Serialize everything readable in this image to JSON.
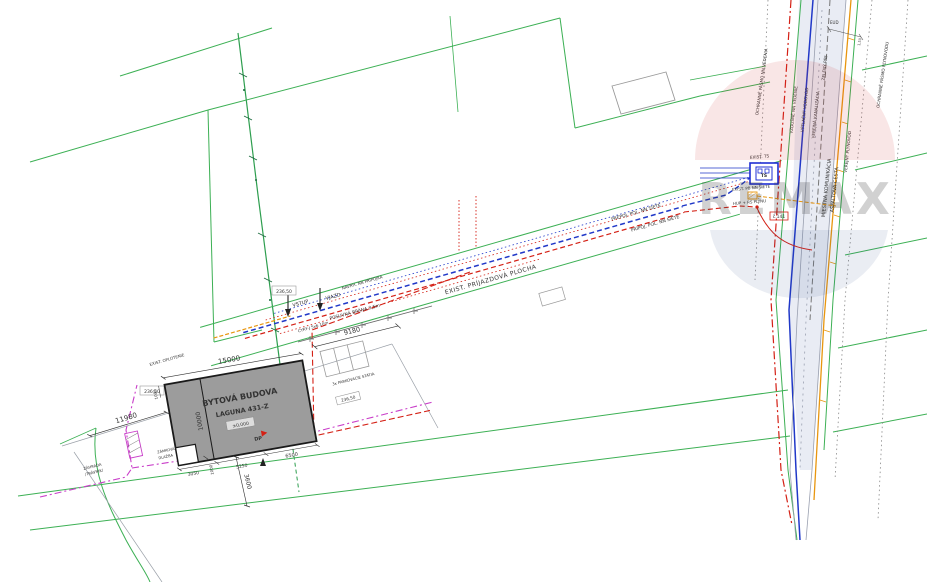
{
  "meta": {
    "title": "Situačný výkres - BYTOVÁ BUDOVA LAGUNA 431-Z"
  },
  "colors": {
    "parcel_green": "#3cb054",
    "boundary_red": "#d42015",
    "cable_blue": "#2038c8",
    "fence_magenta": "#c93ec9",
    "gas_orange": "#e8960f",
    "building_gray": "#9c9c9c",
    "road_tint": "#e2e6f0",
    "watermark_red": "#c03030",
    "watermark_blue": "#33508c"
  },
  "building": {
    "line1": "BYTOVÁ BUDOVA",
    "line2": "LAGUNA 431-Z",
    "elevation": "±0,000",
    "dp": "DP"
  },
  "dimensions": {
    "top": "15000",
    "left": "10000",
    "left_small": "1000",
    "plot": "11980",
    "parking": "9180",
    "bottom_a": "3050",
    "bottom_b": "1000",
    "bottom_c": "5250",
    "bottom_d": "6500",
    "below": "3600",
    "road_top": "EUD",
    "road_ticks": "1,50"
  },
  "site": {
    "vstup": "VSTUP",
    "vjazd": "VJAZD",
    "gate": "POSUVNÁ BRÁNA 3,5m",
    "fence": "EXIST. OPLOTENIE",
    "garden1": "ZÁHRADA",
    "garden2": "/TRÁVNIK/",
    "paving1": "ZÁMKOVÁ",
    "paving2": "DLAŽBA",
    "parking": "3x PARKOVACIE STÁTIA",
    "elev1": "236,50",
    "elev2": "236,50",
    "elev3": "236,50"
  },
  "corridor": {
    "blue": "PREPOJ. POL. NN SIETE",
    "red": "PRÍPOJ. POL. NN SIETE",
    "surface": "EXIST. PRÍJAZDOVÁ PLOCHA",
    "cable_red": "CYKY-J 5x6 10m",
    "cable_blue": "NAVRH. NN PRÍPOJKA"
  },
  "road": {
    "nn": "VZDUŠNÉ NN VEDENIE",
    "water": "VÝTLAČNÝ VODOVOD",
    "sewer": "VEREJNÁ KANALIZÁCIA",
    "name1": "MIESTNA KOMUNIKÁCIA",
    "name2": "ASFALTOVÁ CESTA",
    "gas": "VEREJNÝ PLYNOVOD",
    "zone_left": "OCHRANNÉ PÁSMO NN VEDENIA",
    "zone_right": "OCHRANNÉ PÁSMO PLYNOVODU",
    "green_strip": "ZELENÝ PÁS",
    "ts": "TS",
    "ts_label": "EXIST. TS",
    "pb": "EXIST. PB NN SIETE",
    "pole_no": "č.141",
    "hup": "HUP + RS PLYNU"
  },
  "watermark": {
    "text": "REMAX"
  }
}
